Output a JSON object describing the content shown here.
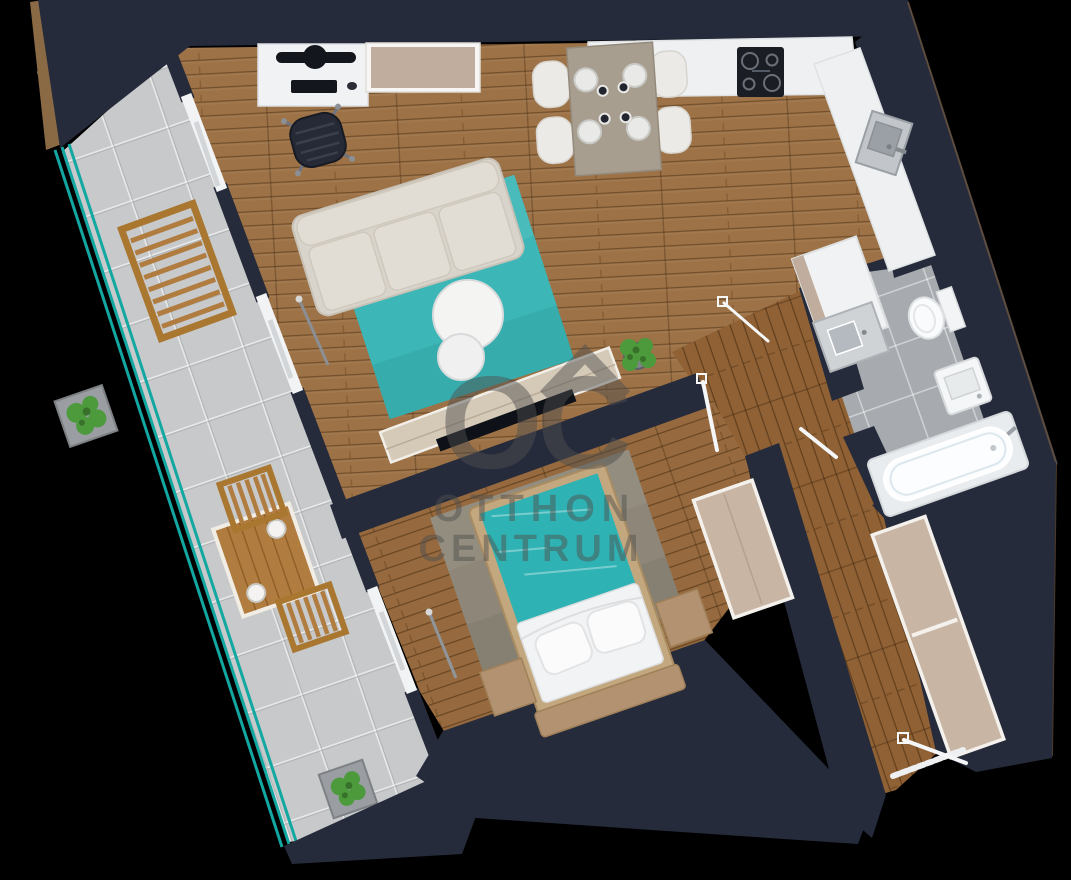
{
  "watermark": {
    "logo_text": "OC",
    "brand_line1": "OTTHON",
    "brand_line2": "CENTRUM"
  },
  "palette": {
    "background": "#000000",
    "wall": "#262b3b",
    "wall_edge": "#8a6a45",
    "wood_living": "#9d7246",
    "wood_bedroom": "#966a3e",
    "wood_hall": "#8f6134",
    "terrace_tile": "#c7c9cb",
    "bath_tile": "#a7abaf",
    "railing_teal": "#13a7a2",
    "rug_teal": "#3cb6b6",
    "bed_teal": "#2fb2b3",
    "sofa": "#d9d4cb",
    "cushion": "#e2ddd4",
    "dining_table": "#a89e90",
    "chair_white": "#eceae6",
    "counter_white": "#eef0f2",
    "appliance_black": "#1a1d24",
    "cabinet_beige": "#c0ad9d",
    "wardrobe_beige": "#c8b5a4",
    "bed_frame_tan": "#c2a77f",
    "bench_tan": "#b29270",
    "bedroom_rug": "#8e8779",
    "fixture_white": "#f2f4f5",
    "wood_outdoor": "#b07c3f",
    "plant_green": "#4c9a3c",
    "watermark_gray": "#4f4f4f"
  }
}
